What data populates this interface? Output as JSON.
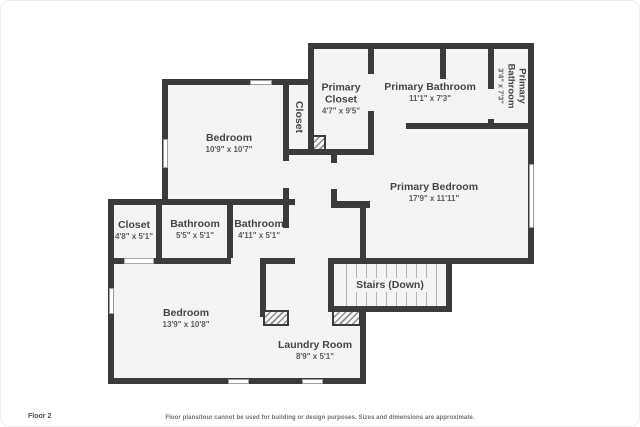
{
  "floor_label": "Floor 2",
  "disclaimer": "Floor plans/tour cannot be used for building or design purposes. Sizes and dimensions are approximate.",
  "colors": {
    "wall": "#3b3b3e",
    "room_fill": "#f4f4f4",
    "label_text": "#454547",
    "background": "#ffffff"
  },
  "rooms": {
    "primary_closet": {
      "name": "Primary Closet",
      "dims": "4'7\" x 9'5\""
    },
    "primary_bathroom": {
      "name": "Primary Bathroom",
      "dims": "11'1\" x 7'3\""
    },
    "primary_bathroom_2": {
      "name": "Primary Bathroom",
      "dims": "3'4\" x 7'3\""
    },
    "hall_closet": {
      "name": "Closet"
    },
    "bedroom_1": {
      "name": "Bedroom",
      "dims": "10'9\" x 10'7\""
    },
    "primary_bedroom": {
      "name": "Primary Bedroom",
      "dims": "17'9\" x 11'11\""
    },
    "closet": {
      "name": "Closet",
      "dims": "4'8\" x 5'1\""
    },
    "bathroom_1": {
      "name": "Bathroom",
      "dims": "5'5\" x 5'1\""
    },
    "bathroom_2": {
      "name": "Bathroom",
      "dims": "4'11\" x 5'1\""
    },
    "bedroom_2": {
      "name": "Bedroom",
      "dims": "13'9\" x 10'8\""
    },
    "stairs": {
      "name": "Stairs (Down)"
    },
    "laundry": {
      "name": "Laundry Room",
      "dims": "8'9\" x 5'1\""
    }
  }
}
